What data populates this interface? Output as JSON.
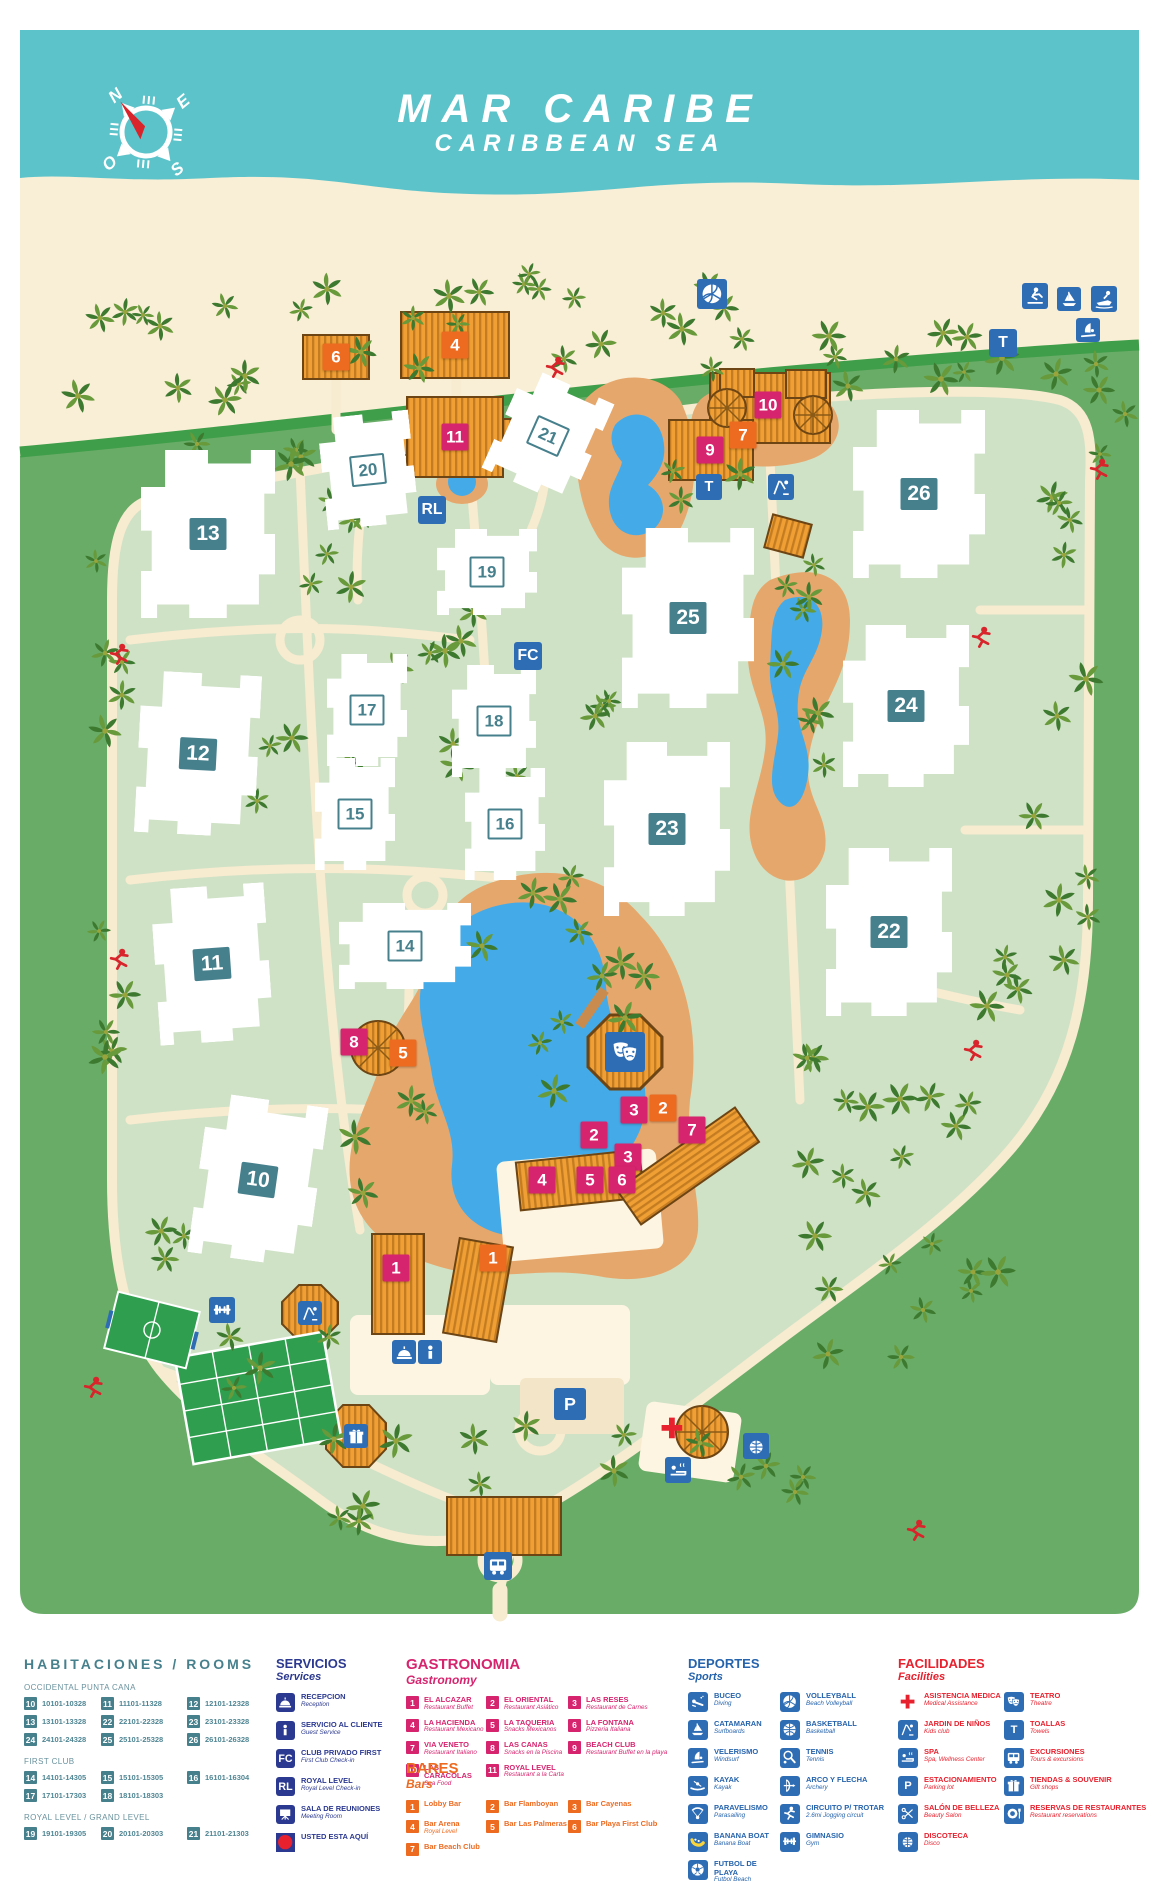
{
  "title": {
    "line1": "MAR CARIBE",
    "line2": "CARIBBEAN SEA"
  },
  "compass": {
    "north": "N",
    "east": "E",
    "south": "S",
    "west": "O"
  },
  "colors": {
    "ocean": "#5cc3ca",
    "beach": "#f9eed6",
    "green_outer": "#69ac68",
    "green_inner": "#cfe2c6",
    "road": "#3f9e49",
    "path": "#f7ebd0",
    "pool": "#44abe8",
    "deck": "#e6a76c",
    "teal": "#47808d",
    "navy": "#2b3990",
    "blue": "#2e6db4",
    "pink": "#d6246e",
    "orange": "#ed6b21",
    "red": "#e8212e",
    "thatch": "#ef9f33",
    "thatch_dark": "#c47c22",
    "court": "#2f9e4f"
  },
  "legend": {
    "rooms": {
      "title": "HABITACIONES / ROOMS",
      "groups": [
        {
          "name": "OCCIDENTAL PUNTA CANA",
          "entries": [
            {
              "num": "10",
              "range": "10101-10328"
            },
            {
              "num": "11",
              "range": "11101-11328"
            },
            {
              "num": "12",
              "range": "12101-12328"
            },
            {
              "num": "13",
              "range": "13101-13328"
            },
            {
              "num": "22",
              "range": "22101-22328"
            },
            {
              "num": "23",
              "range": "23101-23328"
            },
            {
              "num": "24",
              "range": "24101-24328"
            },
            {
              "num": "25",
              "range": "25101-25328"
            },
            {
              "num": "26",
              "range": "26101-26328"
            }
          ]
        },
        {
          "name": "FIRST CLUB",
          "entries": [
            {
              "num": "14",
              "range": "14101-14305"
            },
            {
              "num": "15",
              "range": "15101-15305"
            },
            {
              "num": "16",
              "range": "16101-16304"
            },
            {
              "num": "17",
              "range": "17101-17303"
            },
            {
              "num": "18",
              "range": "18101-18303"
            }
          ]
        },
        {
          "name": "ROYAL LEVEL / GRAND LEVEL",
          "entries": [
            {
              "num": "19",
              "range": "19101-19305"
            },
            {
              "num": "20",
              "range": "20101-20303"
            },
            {
              "num": "21",
              "range": "21101-21303"
            }
          ]
        }
      ]
    },
    "services": {
      "title": "SERVICIOS",
      "subtitle": "Services",
      "items": [
        {
          "icon": "reception-icon",
          "glyph": "dome",
          "label": "RECEPCION",
          "sublabel": "Reception"
        },
        {
          "icon": "guest-service-icon",
          "glyph": "info",
          "label": "SERVICIO AL CLIENTE",
          "sublabel": "Guest Service"
        },
        {
          "icon": "first-club-checkin-icon",
          "glyph": "FC",
          "label": "CLUB PRIVADO FIRST",
          "sublabel": "First Club Check-in"
        },
        {
          "icon": "royal-level-checkin-icon",
          "glyph": "RL",
          "label": "ROYAL LEVEL",
          "sublabel": "Royal Level Check-in"
        },
        {
          "icon": "meeting-room-icon",
          "glyph": "projector",
          "label": "SALA DE REUNIONES",
          "sublabel": "Meeting Room"
        },
        {
          "icon": "you-are-here-dot",
          "glyph": "dot",
          "label": "USTED ESTA AQUÍ",
          "sublabel": ""
        }
      ]
    },
    "gastronomy": {
      "title": "GASTRONOMIA",
      "subtitle": "Gastronomy",
      "columns": [
        [
          {
            "num": "1",
            "label": "EL ALCAZAR",
            "sublabel": "Restaurant Buffet"
          },
          {
            "num": "4",
            "label": "LA HACIENDA",
            "sublabel": "Restaurant Mexicano"
          },
          {
            "num": "7",
            "label": "VIA VENETO",
            "sublabel": "Restaurant Italiano"
          },
          {
            "num": "10",
            "label": "LAS CARACOLAS",
            "sublabel": "Sea Food"
          }
        ],
        [
          {
            "num": "2",
            "label": "EL ORIENTAL",
            "sublabel": "Restaurant Asiático"
          },
          {
            "num": "5",
            "label": "LA TAQUERIA",
            "sublabel": "Snacks Mexicanos"
          },
          {
            "num": "8",
            "label": "LAS CANAS",
            "sublabel": "Snacks en la Piscina"
          },
          {
            "num": "11",
            "label": "ROYAL LEVEL",
            "sublabel": "Restaurant a la Carta"
          }
        ],
        [
          {
            "num": "3",
            "label": "LAS RESES",
            "sublabel": "Restaurant de Carnes"
          },
          {
            "num": "6",
            "label": "LA FONTANA",
            "sublabel": "Pizzeria Italiana"
          },
          {
            "num": "9",
            "label": "BEACH CLUB",
            "sublabel": "Restaurant Buffet en la playa"
          }
        ]
      ]
    },
    "bars": {
      "title": "BARES",
      "subtitle": "Bars",
      "columns": [
        [
          {
            "num": "1",
            "label": "Lobby Bar",
            "sublabel": ""
          },
          {
            "num": "4",
            "label": "Bar Arena",
            "sublabel": "Royal Level"
          },
          {
            "num": "7",
            "label": "Bar Beach Club",
            "sublabel": ""
          }
        ],
        [
          {
            "num": "2",
            "label": "Bar Flamboyan",
            "sublabel": ""
          },
          {
            "num": "5",
            "label": "Bar Las Palmeras",
            "sublabel": ""
          }
        ],
        [
          {
            "num": "3",
            "label": "Bar Cayenas",
            "sublabel": ""
          },
          {
            "num": "6",
            "label": "Bar Playa First Club",
            "sublabel": ""
          }
        ]
      ]
    },
    "sports": {
      "title": "DEPORTES",
      "subtitle": "Sports",
      "columns": [
        [
          {
            "icon": "diving-icon",
            "glyph": "buceo",
            "label": "BUCEO",
            "sublabel": "Diving"
          },
          {
            "icon": "catamaran-icon",
            "glyph": "catamaran",
            "label": "CATAMARAN",
            "sublabel": "Surfboards"
          },
          {
            "icon": "windsurf-icon",
            "glyph": "windsurf",
            "label": "VELERISMO",
            "sublabel": "Windsurf"
          },
          {
            "icon": "kayak-icon",
            "glyph": "kayak",
            "label": "KAYAK",
            "sublabel": "Kayak"
          },
          {
            "icon": "parasailing-icon",
            "glyph": "parasail",
            "label": "PARAVELISMO",
            "sublabel": "Parasailing"
          },
          {
            "icon": "banana-boat-icon",
            "glyph": "banana",
            "label": "BANANA BOAT",
            "sublabel": "Banana Boat"
          },
          {
            "icon": "beach-soccer-icon",
            "glyph": "soccer",
            "label": "FUTBOL DE PLAYA",
            "sublabel": "Futbol Beach"
          }
        ],
        [
          {
            "icon": "volleyball-icon",
            "glyph": "volleyball",
            "label": "VOLLEYBALL",
            "sublabel": "Beach Volleyball"
          },
          {
            "icon": "basketball-icon",
            "glyph": "basketball",
            "label": "BASKETBALL",
            "sublabel": "Basketball"
          },
          {
            "icon": "tennis-icon",
            "glyph": "tennis",
            "label": "TENNIS",
            "sublabel": "Tennis"
          },
          {
            "icon": "archery-icon",
            "glyph": "archery",
            "label": "ARCO Y FLECHA",
            "sublabel": "Archery"
          },
          {
            "icon": "jogging-icon",
            "glyph": "jog",
            "label": "CIRCUITO P/ TROTAR",
            "sublabel": "2.6mi Jogging circuit"
          },
          {
            "icon": "gym-icon",
            "glyph": "gym",
            "label": "GIMNASIO",
            "sublabel": "Gym"
          }
        ]
      ]
    },
    "facilities": {
      "title": "FACILIDADES",
      "subtitle": "Facilities",
      "columns": [
        [
          {
            "icon": "medical-assistance-icon",
            "glyph": "cross",
            "plain": true,
            "label": "ASISTENCIA MEDICA",
            "sublabel": "Medical Assistance"
          },
          {
            "icon": "kids-club-icon",
            "glyph": "playground",
            "label": "JARDIN DE NIÑOS",
            "sublabel": "Kids club"
          },
          {
            "icon": "spa-icon",
            "glyph": "spa",
            "label": "SPA",
            "sublabel": "Spa, Wellness Center"
          },
          {
            "icon": "parking-icon",
            "glyph": "P",
            "label": "ESTACIONAMIENTO",
            "sublabel": "Parking lot"
          },
          {
            "icon": "beauty-salon-icon",
            "glyph": "salon",
            "label": "SALÓN DE BELLEZA",
            "sublabel": "Beauty Salon"
          },
          {
            "icon": "disco-icon",
            "glyph": "disco",
            "label": "DISCOTECA",
            "sublabel": "Disco"
          }
        ],
        [
          {
            "icon": "theatre-icon",
            "glyph": "masks",
            "label": "TEATRO",
            "sublabel": "Theatre"
          },
          {
            "icon": "towels-icon",
            "glyph": "T",
            "label": "TOALLAS",
            "sublabel": "Towels"
          },
          {
            "icon": "excursions-icon",
            "glyph": "bus",
            "label": "EXCURSIONES",
            "sublabel": "Tours & excursions"
          },
          {
            "icon": "gift-shop-icon",
            "glyph": "gift",
            "label": "TIENDAS & SOUVENIR",
            "sublabel": "Gift shops"
          },
          {
            "icon": "restaurant-reservations-icon",
            "glyph": "plate",
            "label": "RESERVAS DE RESTAURANTES",
            "sublabel": "Restaurant reservations"
          }
        ]
      ]
    }
  },
  "map": {
    "buildings": [
      {
        "num": "13",
        "x": 208,
        "y": 534,
        "w": 134,
        "h": 168,
        "style": "solid",
        "rot": 0
      },
      {
        "num": "12",
        "x": 198,
        "y": 754,
        "w": 120,
        "h": 162,
        "style": "solid",
        "rot": 3
      },
      {
        "num": "11",
        "x": 212,
        "y": 964,
        "w": 114,
        "h": 156,
        "style": "solid",
        "rot": -4
      },
      {
        "num": "10",
        "x": 258,
        "y": 1180,
        "w": 120,
        "h": 162,
        "style": "solid",
        "rot": 8
      },
      {
        "num": "20",
        "x": 368,
        "y": 470,
        "w": 92,
        "h": 112,
        "style": "outline",
        "rot": -6
      },
      {
        "num": "21",
        "x": 548,
        "y": 436,
        "w": 96,
        "h": 112,
        "style": "outline",
        "rot": 24
      },
      {
        "num": "19",
        "x": 487,
        "y": 572,
        "w": 100,
        "h": 86,
        "style": "outline",
        "rot": 0
      },
      {
        "num": "17",
        "x": 367,
        "y": 710,
        "w": 80,
        "h": 112,
        "style": "outline",
        "rot": 0
      },
      {
        "num": "18",
        "x": 494,
        "y": 721,
        "w": 84,
        "h": 112,
        "style": "outline",
        "rot": 0
      },
      {
        "num": "15",
        "x": 355,
        "y": 814,
        "w": 80,
        "h": 112,
        "style": "outline",
        "rot": 0
      },
      {
        "num": "16",
        "x": 505,
        "y": 824,
        "w": 80,
        "h": 112,
        "style": "outline",
        "rot": 0
      },
      {
        "num": "14",
        "x": 405,
        "y": 946,
        "w": 132,
        "h": 86,
        "style": "outline",
        "rot": 0
      },
      {
        "num": "25",
        "x": 688,
        "y": 618,
        "w": 132,
        "h": 180,
        "style": "solid",
        "rot": 0
      },
      {
        "num": "23",
        "x": 667,
        "y": 829,
        "w": 126,
        "h": 174,
        "style": "solid",
        "rot": 0
      },
      {
        "num": "26",
        "x": 919,
        "y": 494,
        "w": 132,
        "h": 168,
        "style": "solid",
        "rot": 0
      },
      {
        "num": "24",
        "x": 906,
        "y": 706,
        "w": 126,
        "h": 162,
        "style": "solid",
        "rot": 0
      },
      {
        "num": "22",
        "x": 889,
        "y": 932,
        "w": 126,
        "h": 168,
        "style": "solid",
        "rot": 0
      }
    ],
    "markers": [
      {
        "num": "4",
        "type": "bar",
        "x": 455,
        "y": 345
      },
      {
        "num": "6",
        "type": "bar",
        "x": 336,
        "y": 357
      },
      {
        "num": "11",
        "type": "restaurant",
        "x": 455,
        "y": 437
      },
      {
        "num": "10",
        "type": "restaurant",
        "x": 768,
        "y": 405
      },
      {
        "num": "7",
        "type": "bar",
        "x": 743,
        "y": 435
      },
      {
        "num": "9",
        "type": "restaurant",
        "x": 710,
        "y": 450
      },
      {
        "num": "8",
        "type": "restaurant",
        "x": 354,
        "y": 1042
      },
      {
        "num": "5",
        "type": "bar",
        "x": 403,
        "y": 1053
      },
      {
        "num": "3",
        "type": "restaurant",
        "x": 634,
        "y": 1110
      },
      {
        "num": "2",
        "type": "bar",
        "x": 663,
        "y": 1108
      },
      {
        "num": "2",
        "type": "restaurant",
        "x": 594,
        "y": 1135
      },
      {
        "num": "7",
        "type": "restaurant",
        "x": 692,
        "y": 1130
      },
      {
        "num": "3",
        "type": "restaurant",
        "x": 628,
        "y": 1157
      },
      {
        "num": "4",
        "type": "restaurant",
        "x": 542,
        "y": 1180
      },
      {
        "num": "5",
        "type": "restaurant",
        "x": 590,
        "y": 1180
      },
      {
        "num": "6",
        "type": "restaurant",
        "x": 622,
        "y": 1180
      },
      {
        "num": "1",
        "type": "restaurant",
        "x": 396,
        "y": 1268
      },
      {
        "num": "1",
        "type": "bar",
        "x": 493,
        "y": 1258
      }
    ],
    "icons": [
      {
        "name": "volleyball-icon",
        "glyph": "volleyball",
        "x": 712,
        "y": 294,
        "s": 30
      },
      {
        "name": "water-ski-icon",
        "glyph": "waterski",
        "x": 1035,
        "y": 296,
        "s": 26
      },
      {
        "name": "sailing-icon",
        "glyph": "catamaran",
        "x": 1069,
        "y": 299,
        "s": 24
      },
      {
        "name": "jet-ski-icon",
        "glyph": "jetski",
        "x": 1104,
        "y": 299,
        "s": 26
      },
      {
        "name": "windsurf-icon",
        "glyph": "windsurf",
        "x": 1088,
        "y": 330,
        "s": 24
      },
      {
        "name": "towels-icon",
        "glyph": "T",
        "x": 1003,
        "y": 343,
        "s": 28
      },
      {
        "name": "towels-icon",
        "glyph": "T",
        "x": 709,
        "y": 487,
        "s": 26
      },
      {
        "name": "kids-club-icon",
        "glyph": "playground",
        "x": 781,
        "y": 487,
        "s": 26
      },
      {
        "name": "royal-level-checkin-icon",
        "glyph": "RL",
        "x": 432,
        "y": 510,
        "s": 28
      },
      {
        "name": "first-club-checkin-icon",
        "glyph": "FC",
        "x": 528,
        "y": 656,
        "s": 28
      },
      {
        "name": "theatre-icon",
        "glyph": "masks",
        "x": 625,
        "y": 1052,
        "s": 40
      },
      {
        "name": "gym-icon",
        "glyph": "gym",
        "x": 222,
        "y": 1310,
        "s": 26
      },
      {
        "name": "kids-club-icon",
        "glyph": "playground",
        "x": 310,
        "y": 1313,
        "s": 24
      },
      {
        "name": "reception-icon",
        "glyph": "dome",
        "x": 404,
        "y": 1352,
        "s": 24
      },
      {
        "name": "guest-service-icon",
        "glyph": "info",
        "x": 430,
        "y": 1352,
        "s": 24
      },
      {
        "name": "parking-icon",
        "glyph": "P",
        "x": 570,
        "y": 1404,
        "s": 32
      },
      {
        "name": "medical-assistance-icon",
        "glyph": "cross",
        "x": 672,
        "y": 1428,
        "s": 30,
        "plain": true
      },
      {
        "name": "gift-shop-icon",
        "glyph": "gift",
        "x": 356,
        "y": 1436,
        "s": 24
      },
      {
        "name": "spa-icon",
        "glyph": "spa",
        "x": 678,
        "y": 1470,
        "s": 26
      },
      {
        "name": "disco-icon",
        "glyph": "disco",
        "x": 756,
        "y": 1446,
        "s": 26
      },
      {
        "name": "excursions-icon",
        "glyph": "bus",
        "x": 498,
        "y": 1566,
        "s": 28
      },
      {
        "name": "jogger-icon",
        "glyph": "runner",
        "x": 556,
        "y": 368,
        "s": 30,
        "plain": true
      },
      {
        "name": "jogger-icon",
        "glyph": "runner",
        "x": 1100,
        "y": 470,
        "s": 30,
        "plain": true
      },
      {
        "name": "jogger-icon",
        "glyph": "runner",
        "x": 120,
        "y": 655,
        "s": 30,
        "plain": true
      },
      {
        "name": "jogger-icon",
        "glyph": "runner",
        "x": 982,
        "y": 638,
        "s": 30,
        "plain": true
      },
      {
        "name": "jogger-icon",
        "glyph": "runner",
        "x": 120,
        "y": 960,
        "s": 30,
        "plain": true
      },
      {
        "name": "jogger-icon",
        "glyph": "runner",
        "x": 974,
        "y": 1051,
        "s": 30,
        "plain": true
      },
      {
        "name": "jogger-icon",
        "glyph": "runner",
        "x": 94,
        "y": 1388,
        "s": 30,
        "plain": true
      },
      {
        "name": "jogger-icon",
        "glyph": "runner",
        "x": 917,
        "y": 1531,
        "s": 30,
        "plain": true
      }
    ]
  }
}
